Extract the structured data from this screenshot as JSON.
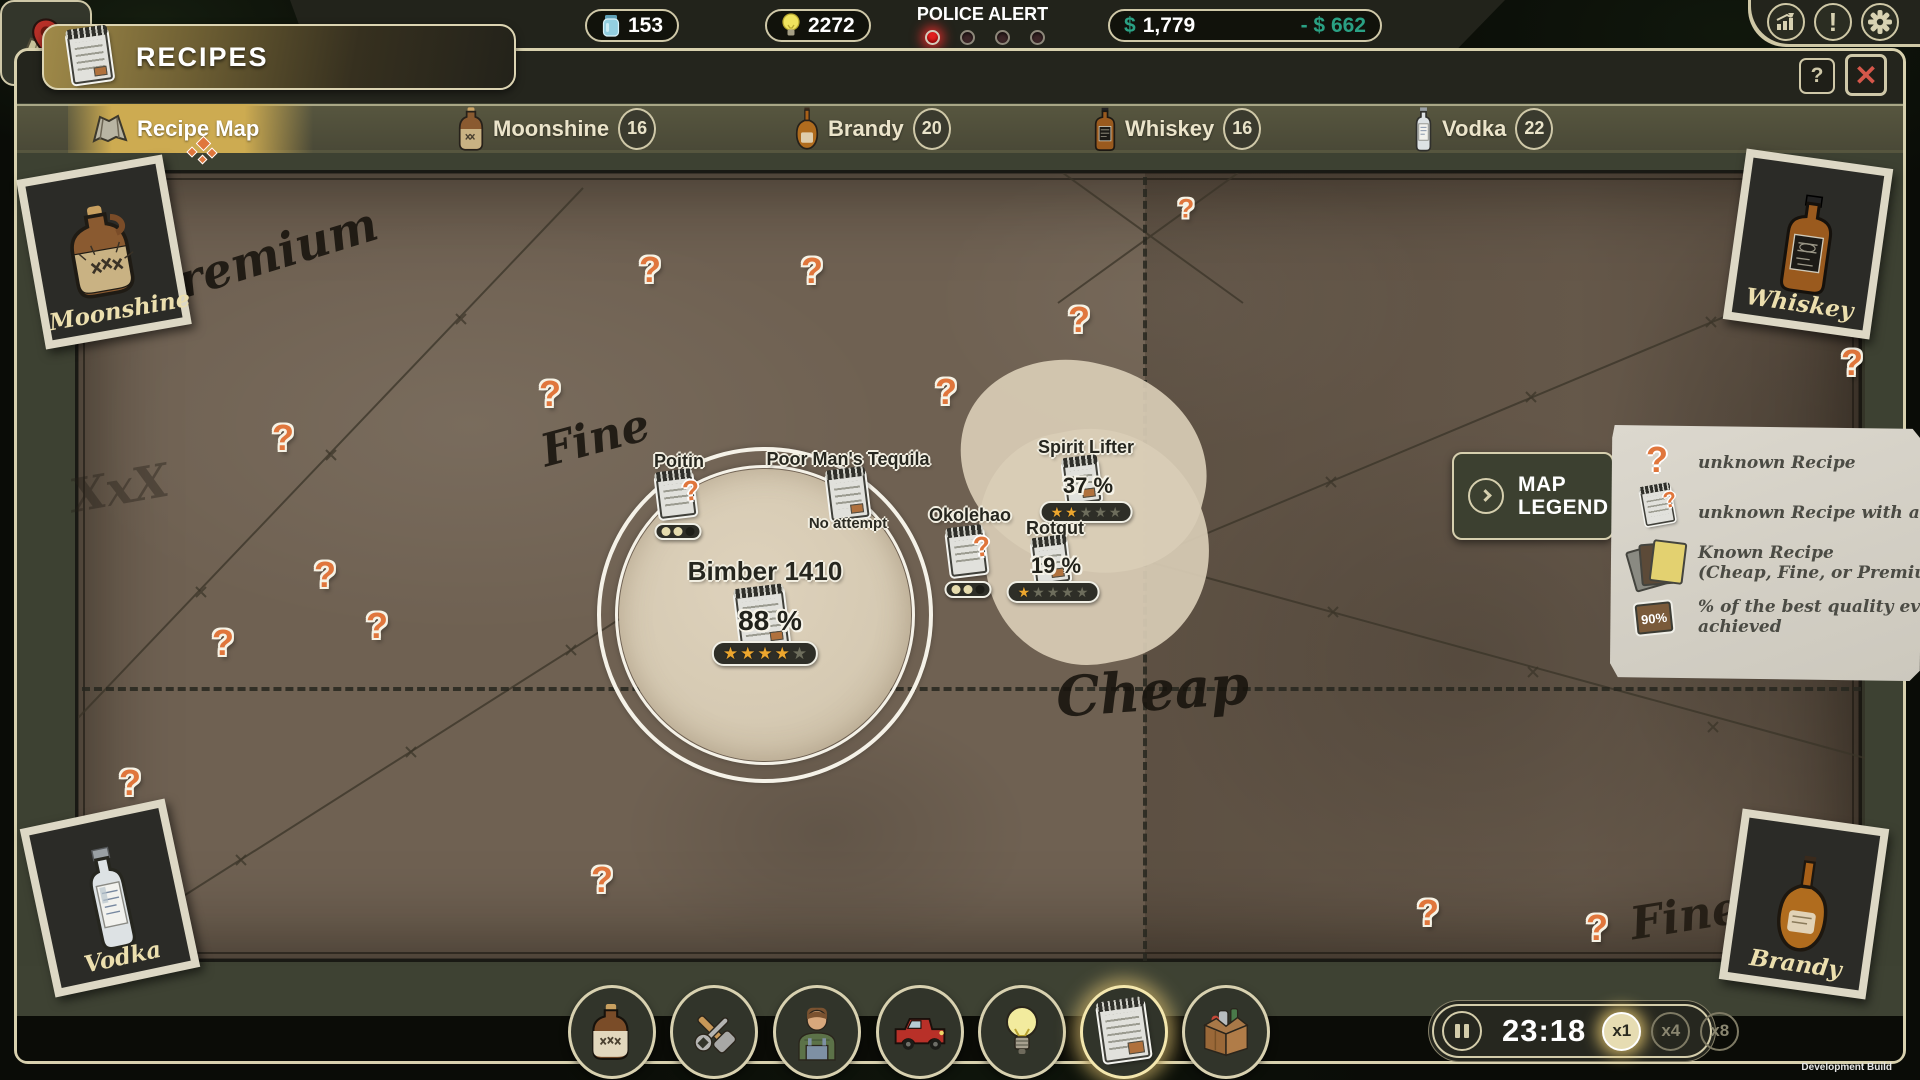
{
  "topbar": {
    "jars": "153",
    "ideas": "2272",
    "police_label": "POLICE ALERT",
    "lights": {
      "total": 4,
      "active": 1
    },
    "cash_symbol": "$",
    "cash_amount": "1,779",
    "delta": "- $ 662"
  },
  "window": {
    "title": "RECIPES",
    "help": "?",
    "close": "✕"
  },
  "tabs": {
    "map": {
      "label": "Recipe Map"
    },
    "moonshine": {
      "label": "Moonshine",
      "count": "16"
    },
    "brandy": {
      "label": "Brandy",
      "count": "20"
    },
    "whiskey": {
      "label": "Whiskey",
      "count": "16"
    },
    "vodka": {
      "label": "Vodka",
      "count": "22"
    }
  },
  "map": {
    "cards": {
      "moonshine": "Moonshine",
      "whiskey": "Whiskey",
      "vodka": "Vodka",
      "brandy": "Brandy"
    },
    "regions": {
      "premium": "Premium",
      "fine_left": "Fine",
      "cheap": "Cheap",
      "fine_right": "Fine"
    },
    "watermark": "XxX",
    "question_mark": "?",
    "recipes": {
      "poitin": {
        "name": "Poitin",
        "dots": [
          true,
          true,
          false
        ]
      },
      "tequila": {
        "name": "Poor Man's Tequila",
        "status": "No attempt"
      },
      "okolehao": {
        "name": "Okolehao",
        "dots": [
          true,
          true,
          false
        ]
      },
      "bimber": {
        "name": "Bimber 1410",
        "quality": "88 %",
        "stars": 4,
        "stars_total": 5
      },
      "spirit_lifter": {
        "name": "Spirit Lifter",
        "quality": "37 %",
        "stars": 2,
        "stars_total": 5
      },
      "rotgut": {
        "name": "Rotgut",
        "quality": "19 %",
        "stars": 1,
        "stars_total": 5
      }
    }
  },
  "legend": {
    "button": {
      "line1": "MAP",
      "line2": "LEGEND"
    },
    "items": [
      {
        "icon": "question-icon",
        "line1": "unknown Recipe",
        "line2": ""
      },
      {
        "icon": "clue-icon",
        "line1": "unknown Recipe with a clue",
        "line2": ""
      },
      {
        "icon": "known-recipes-icon",
        "line1": "Known Recipe",
        "line2": "(Cheap, Fine, or Premium)"
      },
      {
        "icon": "best-quality-icon",
        "badge": "90%",
        "line1": "% of the best quality ever",
        "line2": "achieved"
      }
    ]
  },
  "toolbar": {
    "icons": [
      "jug-icon",
      "tools-icon",
      "staff-icon",
      "truck-icon",
      "ideas-icon",
      "recipes-icon",
      "storage-icon"
    ],
    "selected": "recipes-icon"
  },
  "time": {
    "clock": "23:18",
    "speeds": [
      "x1",
      "x4",
      "x8"
    ],
    "selected": "x1"
  },
  "build": "Development Build",
  "ui": {
    "star": "★"
  },
  "colors": {
    "accent_gold": "#cdab51",
    "question_orange": "#e0763c",
    "money_green": "#2aa184",
    "alert_red": "#e21f1f",
    "star_gold": "#eca62e",
    "map_paper": "#6f6152",
    "chrome_olive": "#3d4132",
    "cream_border": "#d8d1ae",
    "legend_paper": "#d6d2c8"
  }
}
